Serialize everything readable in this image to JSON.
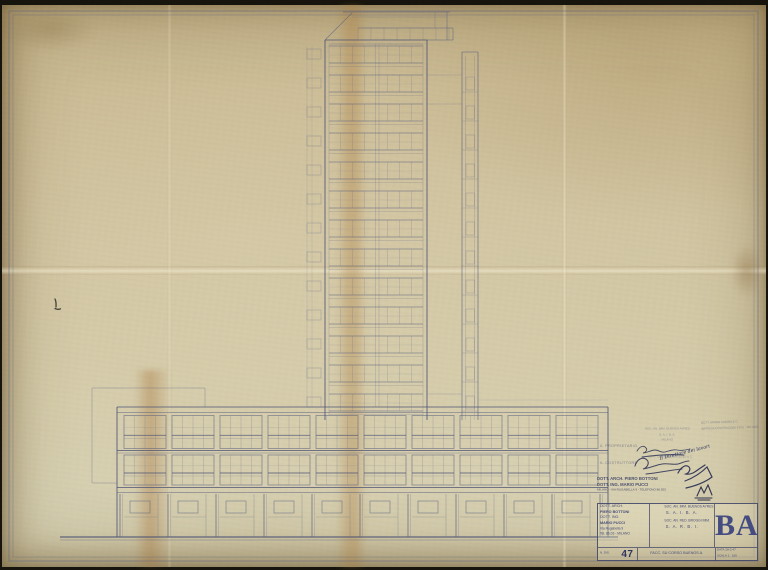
{
  "colors": {
    "paper": "#cfc29e",
    "ink_line": "#565c80",
    "title_ink": "#464c76",
    "monogram_ink": "#39427e",
    "signature_ink": "#2c3156"
  },
  "title_block": {
    "firm_lines": [
      "DOTT. ARCH.",
      "PIERO BOTTONI",
      "DOTT. ING.",
      "MARIO PUCCI",
      "Via Rugabella 9",
      "Tel. 86.03 - MILANO"
    ],
    "client1_name": "SOC. AN. IMM. BUENOS AYRES",
    "client1_sigla": "S. A. I. B. A.",
    "client2_name": "SOC. AN. RED. BROGGI IMM.",
    "client2_sigla": "S. A. R. B. I.",
    "monogram": "BA",
    "dis_label": "N. DIS.",
    "dis_number": "47",
    "sheet_title": "FACC. SU CORSO BUENOS A.",
    "data_label": "DATA",
    "data_value": "28-2-47",
    "scala_label": "SCALA",
    "scala_value": "1 : 100"
  },
  "architect_stamp": {
    "line1": "DOTT. ARCH. PIERO BOTTONI",
    "line2": "DOTT. ING. MARIO PUCCI",
    "line3": "MILANO - VIA RUGABELLA 9 - TELEFONO 86.303"
  },
  "approval": {
    "owner_label": "IL PROPRIETARIO",
    "builder_label": "IL COSTRUTTORE",
    "owner_stamp_lines": [
      "SOC. AN. IMM. BUENOS AYRES",
      "S. A. I. B. A.",
      "MILANO"
    ],
    "builder_stamp_line": "IMPR. COSTRUZIONI EDILI & C.",
    "director_note": "Il Direttore dei lavori"
  },
  "corner_stamp": {
    "line1": "DOTT. MARIO COMBA & C.",
    "line2": "IMPRESA COSTRUZIONI EDILI - MILANO"
  },
  "drawing": {
    "scale": "1 : 100",
    "tower_floors": 13,
    "floor_height_px": 29,
    "base_bays": 10,
    "bay_width_px": 48,
    "ground_line_y": 537
  }
}
